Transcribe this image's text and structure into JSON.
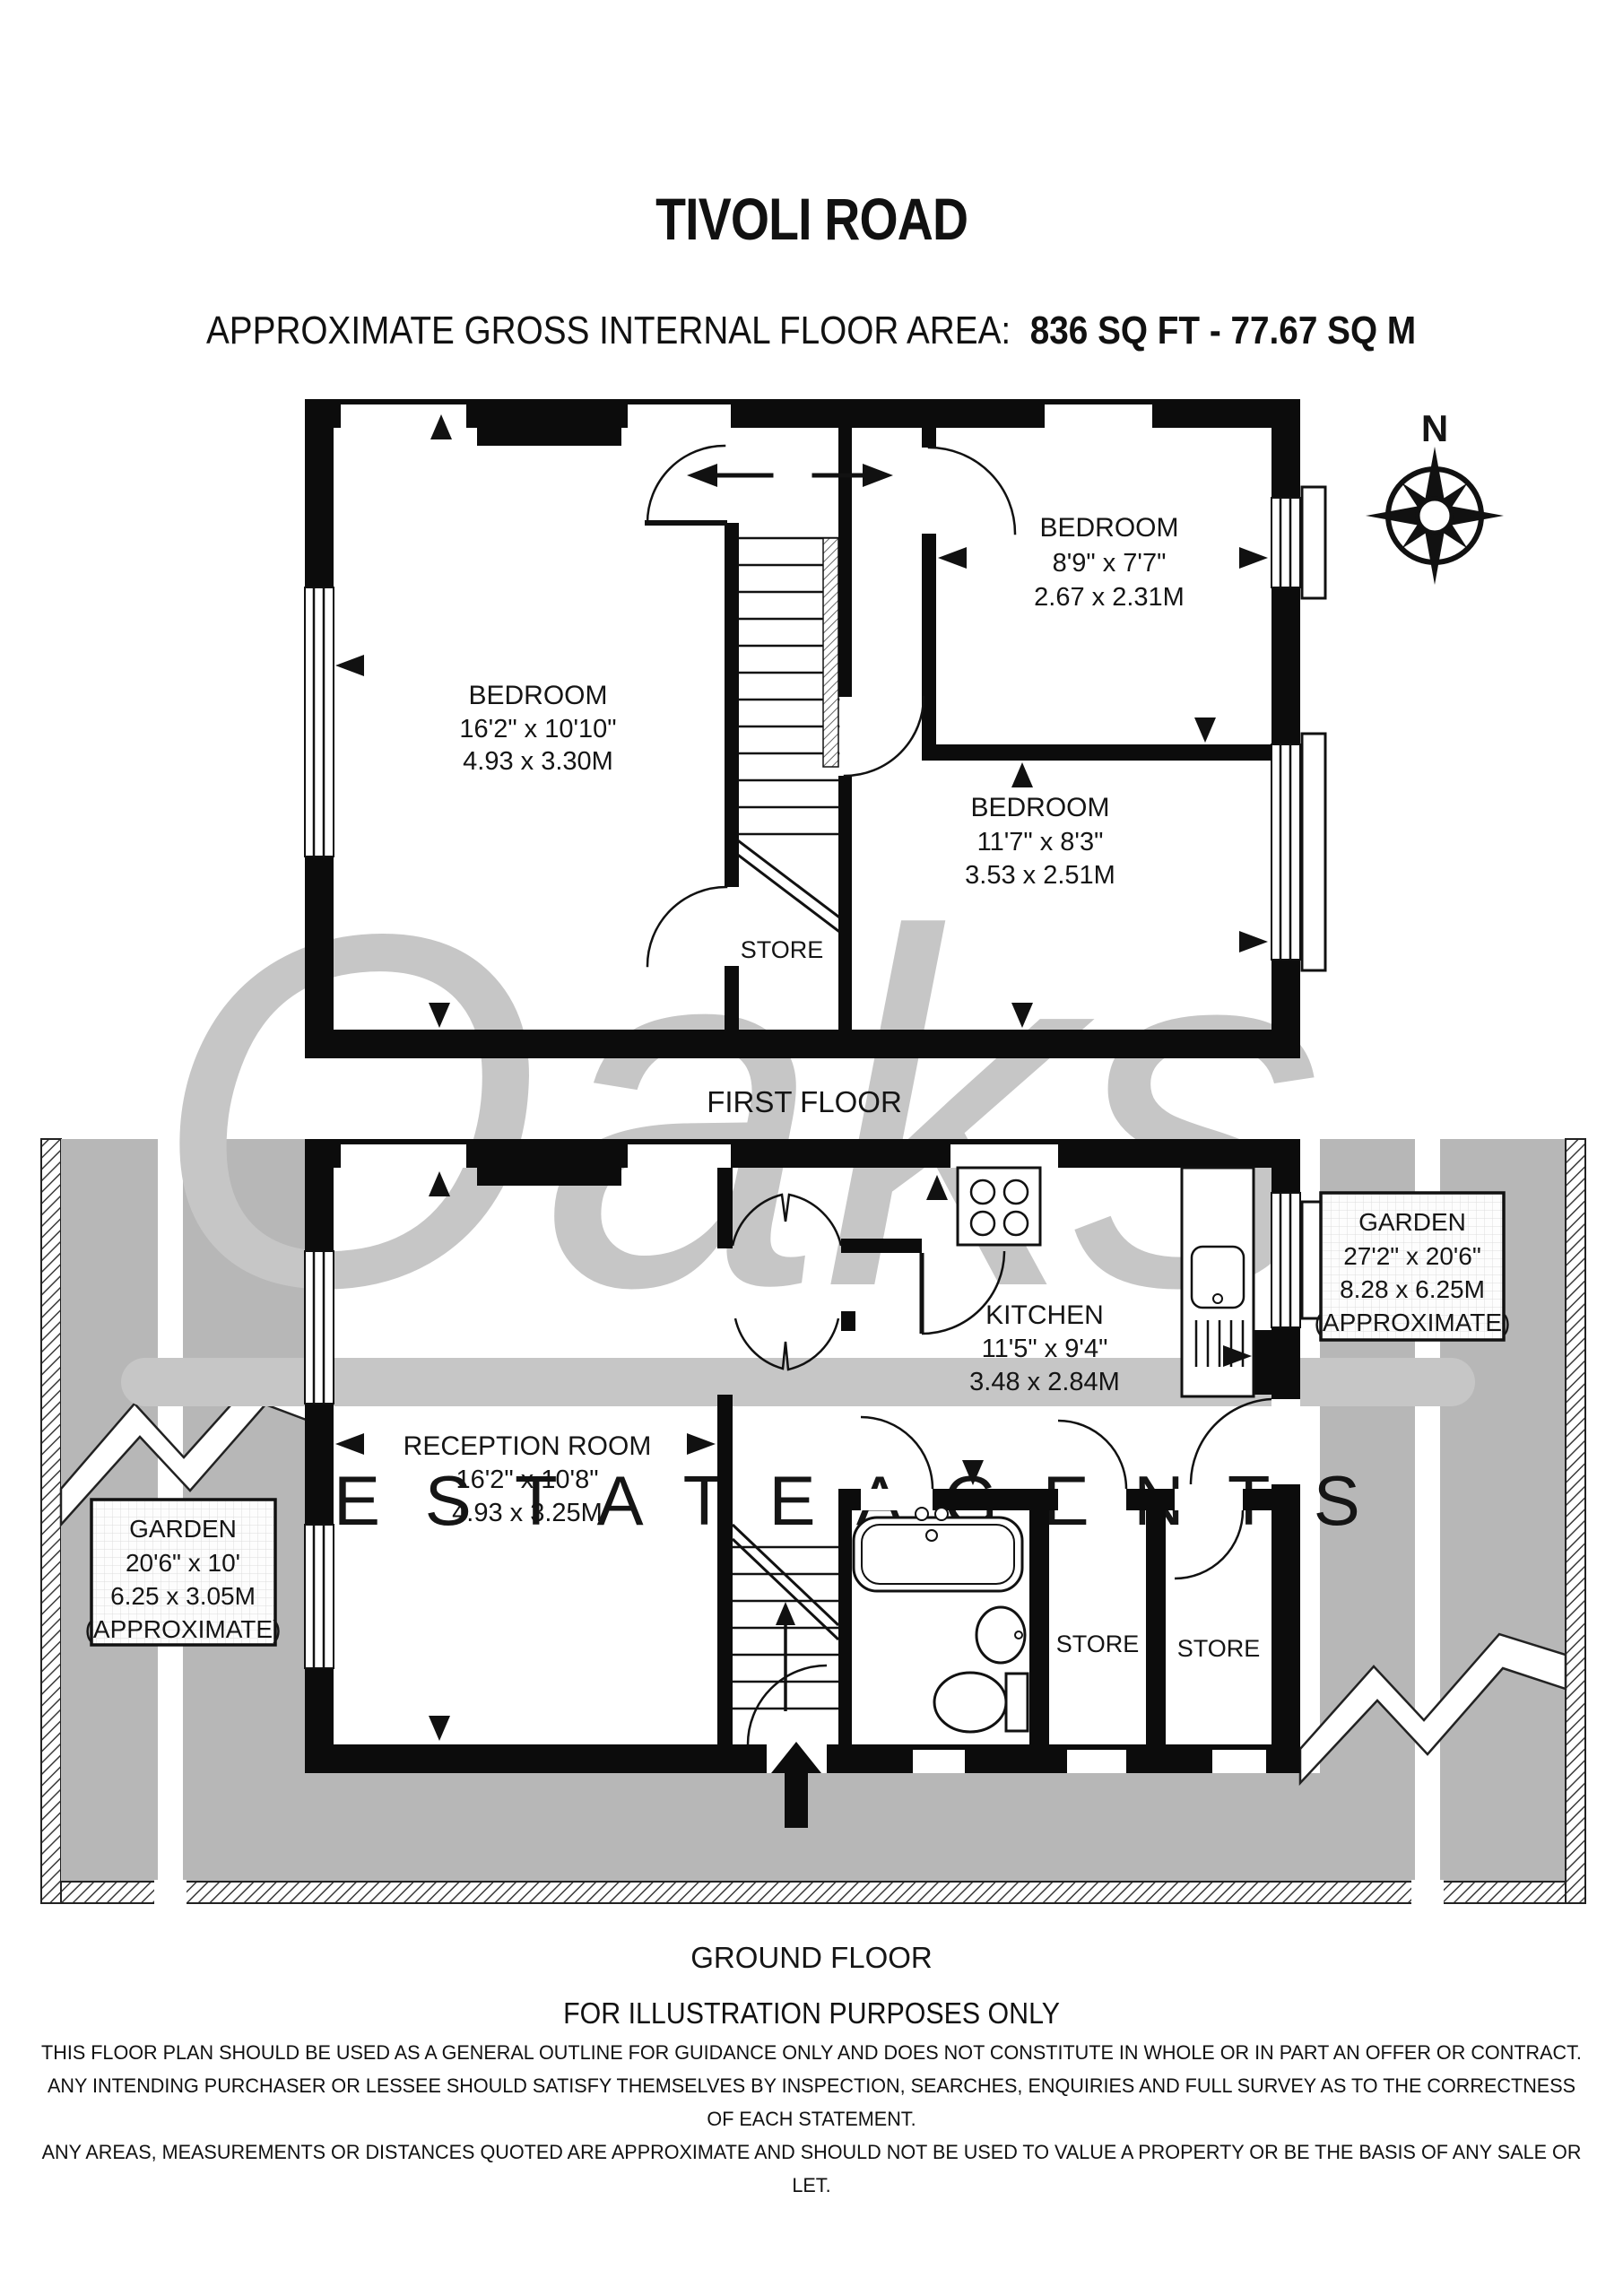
{
  "header": {
    "title": "TIVOLI ROAD",
    "subtitle_label": "APPROXIMATE GROSS INTERNAL FLOOR AREA:",
    "subtitle_value": "836 SQ FT  -  77.67 SQ M"
  },
  "watermark": {
    "script": "Oaks",
    "subtext": "E S T A T E   A G E N T S"
  },
  "compass": {
    "north_label": "N"
  },
  "first_floor": {
    "caption": "FIRST FLOOR",
    "bedroom1": {
      "name": "BEDROOM",
      "imperial": "16'2\" x 10'10\"",
      "metric": "4.93 x 3.30M"
    },
    "bedroom2": {
      "name": "BEDROOM",
      "imperial": "8'9\" x 7'7\"",
      "metric": "2.67 x 2.31M"
    },
    "bedroom3": {
      "name": "BEDROOM",
      "imperial": "11'7\" x 8'3\"",
      "metric": "3.53 x 2.51M"
    },
    "store": {
      "name": "STORE"
    }
  },
  "ground_floor": {
    "caption": "GROUND FLOOR",
    "reception": {
      "name": "RECEPTION ROOM",
      "imperial": "16'2\" x 10'8\"",
      "metric": "4.93 x 3.25M"
    },
    "kitchen": {
      "name": "KITCHEN",
      "imperial": "11'5\" x 9'4\"",
      "metric": "3.48 x 2.84M"
    },
    "store1": {
      "name": "STORE"
    },
    "store2": {
      "name": "STORE"
    },
    "garden_right": {
      "name": "GARDEN",
      "imperial": "27'2\" x 20'6\"",
      "metric": "8.28 x 6.25M",
      "note": "(APPROXIMATE)"
    },
    "garden_left": {
      "name": "GARDEN",
      "imperial": "20'6\" x 10'",
      "metric": "6.25 x 3.05M",
      "note": "(APPROXIMATE)"
    }
  },
  "footer": {
    "illustration_note": "FOR ILLUSTRATION PURPOSES ONLY",
    "disclaimer_line1": "THIS FLOOR PLAN SHOULD BE USED AS A GENERAL OUTLINE FOR GUIDANCE ONLY AND DOES NOT CONSTITUTE IN WHOLE OR IN PART AN OFFER OR CONTRACT.",
    "disclaimer_line2": "ANY INTENDING PURCHASER OR LESSEE SHOULD SATISFY THEMSELVES BY INSPECTION, SEARCHES, ENQUIRIES AND FULL SURVEY AS TO THE CORRECTNESS OF EACH STATEMENT.",
    "disclaimer_line3": "ANY AREAS, MEASUREMENTS OR DISTANCES QUOTED ARE APPROXIMATE AND SHOULD NOT BE USED TO VALUE A PROPERTY OR BE THE BASIS OF ANY SALE OR LET."
  }
}
